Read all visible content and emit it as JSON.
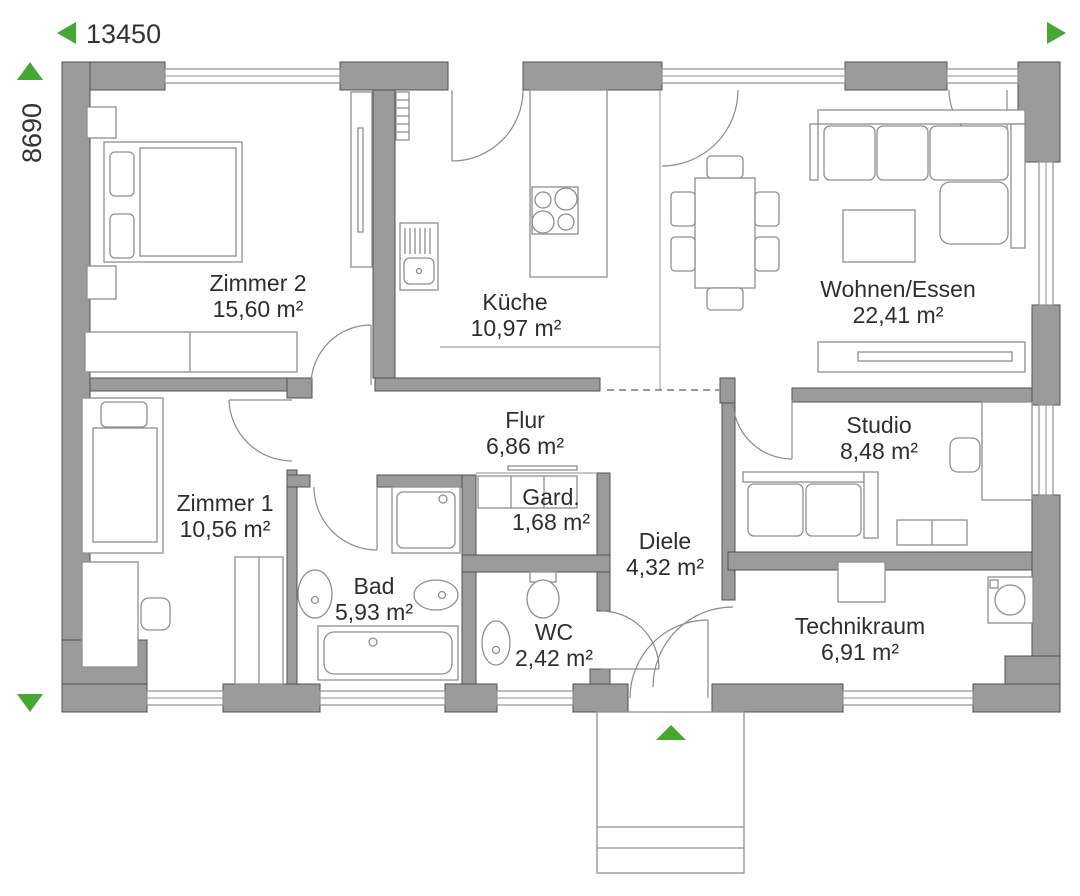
{
  "plan": {
    "dimensions": {
      "width_label": "13450",
      "height_label": "8690"
    },
    "rooms": [
      {
        "name": "Zimmer 2",
        "area": "15,60 m²"
      },
      {
        "name": "Küche",
        "area": "10,97 m²"
      },
      {
        "name": "Wohnen/Essen",
        "area": "22,41 m²"
      },
      {
        "name": "Zimmer 1",
        "area": "10,56 m²"
      },
      {
        "name": "Flur",
        "area": "6,86 m²"
      },
      {
        "name": "Gard.",
        "area": "1,68 m²"
      },
      {
        "name": "Bad",
        "area": "5,93 m²"
      },
      {
        "name": "WC",
        "area": "2,42 m²"
      },
      {
        "name": "Diele",
        "area": "4,32 m²"
      },
      {
        "name": "Studio",
        "area": "8,48 m²"
      },
      {
        "name": "Technikraum",
        "area": "6,91 m²"
      }
    ],
    "icons": {
      "dimension_arrows": "green triangles marking overall width and height",
      "entrance_arrow": "green triangle marking main entrance"
    },
    "colors": {
      "wall": "#9b9b9b",
      "wall_outline": "#505050",
      "furniture_line": "#8f8f8f",
      "accent_green": "#46a735",
      "text": "#2e2e2e"
    }
  }
}
